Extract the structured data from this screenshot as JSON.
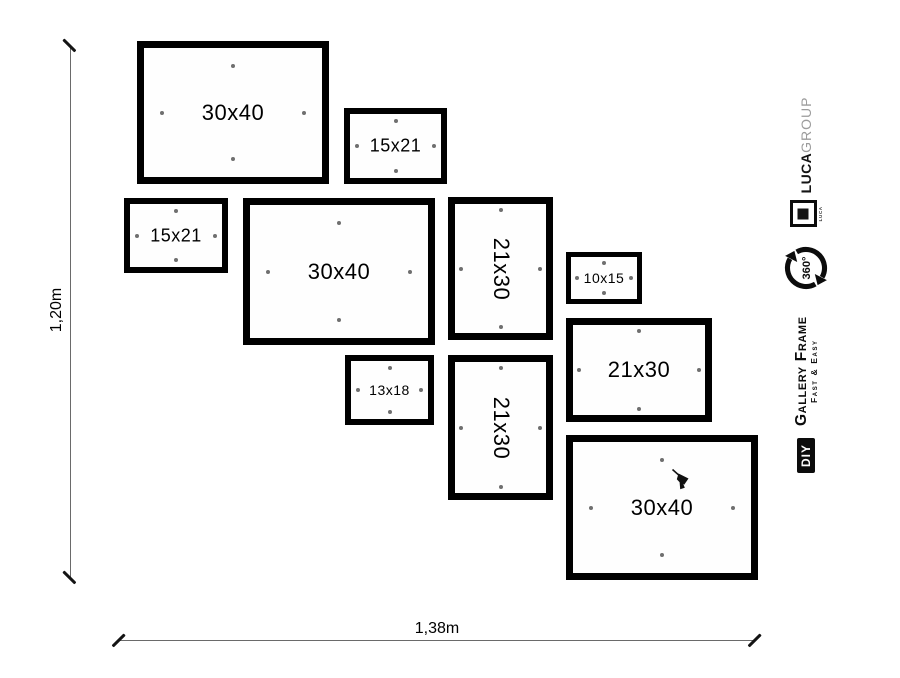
{
  "canvas": {
    "width": 900,
    "height": 678,
    "background": "#ffffff"
  },
  "colors": {
    "frame_border": "#000000",
    "hanging_dot": "#6f6f6f",
    "dimension_line": "#6a6a6a",
    "dimension_tick": "#141414",
    "text": "#000000",
    "brand_gray": "#9c9c9c",
    "badge_bg": "#0c0c0c",
    "badge_text": "#ffffff"
  },
  "dimensions": {
    "height_label": "1,20m",
    "width_label": "1,38m"
  },
  "frames": [
    {
      "label": "30x40",
      "x": 137,
      "y": 41,
      "w": 192,
      "h": 143,
      "border": 7,
      "font": 22,
      "dot_offset": 16,
      "rotated": false
    },
    {
      "label": "15x21",
      "x": 344,
      "y": 108,
      "w": 103,
      "h": 76,
      "border": 6,
      "font": 18,
      "dot_offset": 5,
      "rotated": false
    },
    {
      "label": "15x21",
      "x": 124,
      "y": 198,
      "w": 104,
      "h": 75,
      "border": 6,
      "font": 18,
      "dot_offset": 5,
      "rotated": false
    },
    {
      "label": "30x40",
      "x": 243,
      "y": 198,
      "w": 192,
      "h": 147,
      "border": 7,
      "font": 22,
      "dot_offset": 16,
      "rotated": false
    },
    {
      "label": "21x30",
      "x": 448,
      "y": 197,
      "w": 105,
      "h": 143,
      "border": 7,
      "font": 22,
      "dot_offset": 4,
      "rotated": true
    },
    {
      "label": "10x15",
      "x": 566,
      "y": 252,
      "w": 76,
      "h": 52,
      "border": 5,
      "font": 14,
      "dot_offset": 4,
      "rotated": false
    },
    {
      "label": "21x30",
      "x": 566,
      "y": 318,
      "w": 146,
      "h": 104,
      "border": 7,
      "font": 22,
      "dot_offset": 4,
      "rotated": false
    },
    {
      "label": "13x18",
      "x": 345,
      "y": 355,
      "w": 89,
      "h": 70,
      "border": 6,
      "font": 14,
      "dot_offset": 5,
      "rotated": false
    },
    {
      "label": "21x30",
      "x": 448,
      "y": 355,
      "w": 105,
      "h": 145,
      "border": 7,
      "font": 22,
      "dot_offset": 4,
      "rotated": true
    },
    {
      "label": "30x40",
      "x": 566,
      "y": 435,
      "w": 192,
      "h": 145,
      "border": 7,
      "font": 22,
      "dot_offset": 16,
      "rotated": false,
      "drill": {
        "x": 98,
        "y": 26
      }
    }
  ],
  "branding": {
    "brand_bold": "LUCA",
    "brand_light": "GROUP",
    "logo_small_text": "LUCA",
    "rotation_label": "360°",
    "product_line1": "Gallery Frame",
    "product_line2": "Fast & Easy",
    "diy_label": "DIY"
  }
}
